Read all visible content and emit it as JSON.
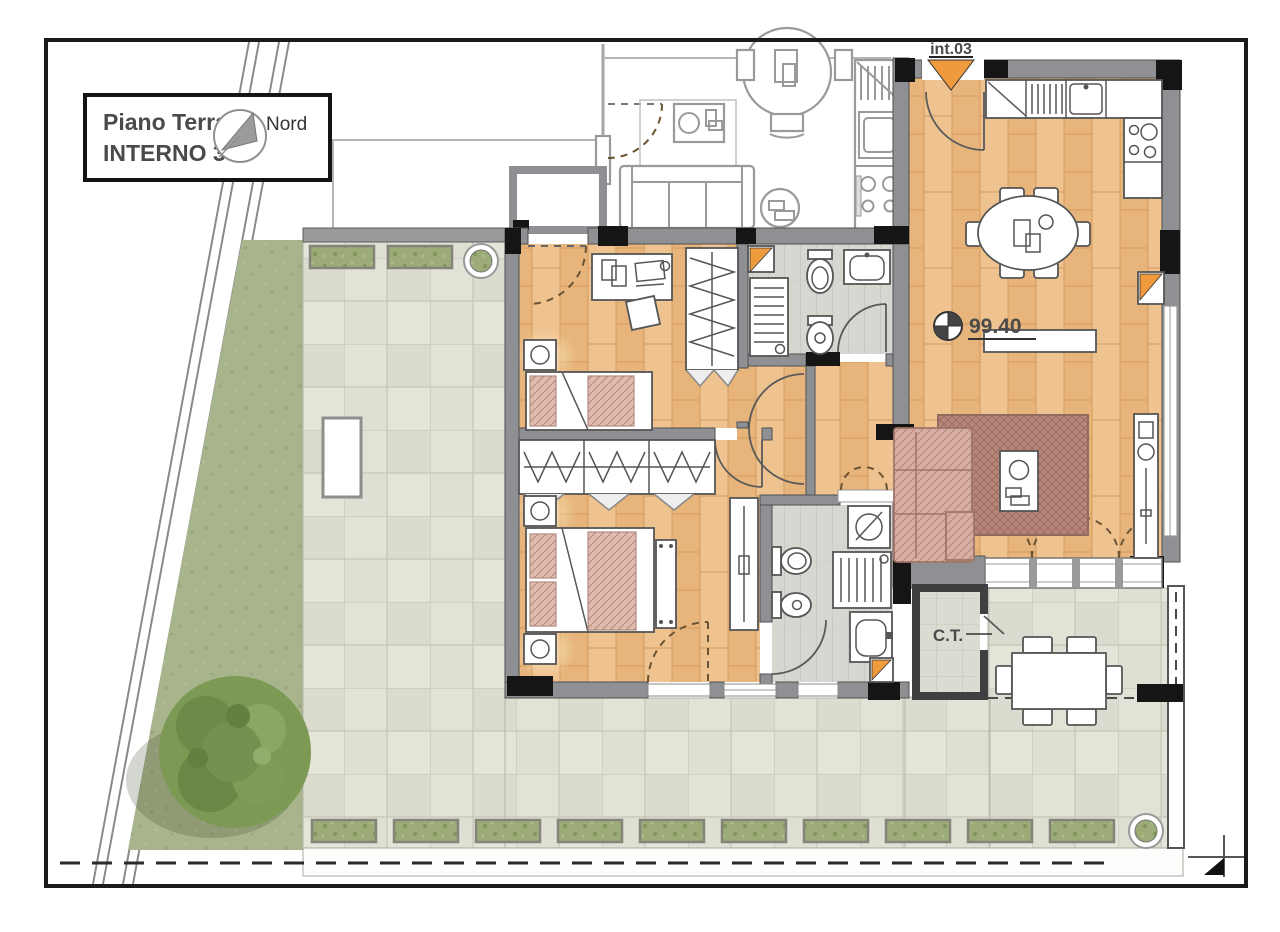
{
  "title_block": {
    "floor": "Piano Terra",
    "unit": "INTERNO 3",
    "compass": "Nord"
  },
  "labels": {
    "entrance": "int.03",
    "level": "99.40",
    "boiler": "C.T."
  },
  "colors": {
    "wood_floor": "#eaba82",
    "terrace_tile": "#dfdfd3",
    "lawn": "#a8b48b",
    "hedge": "#9cab77",
    "wall_gray": "#8e9093",
    "accent_orange": "#ef9a3d",
    "rug": "#b7857a",
    "sofa_pink": "#d7aea2"
  }
}
